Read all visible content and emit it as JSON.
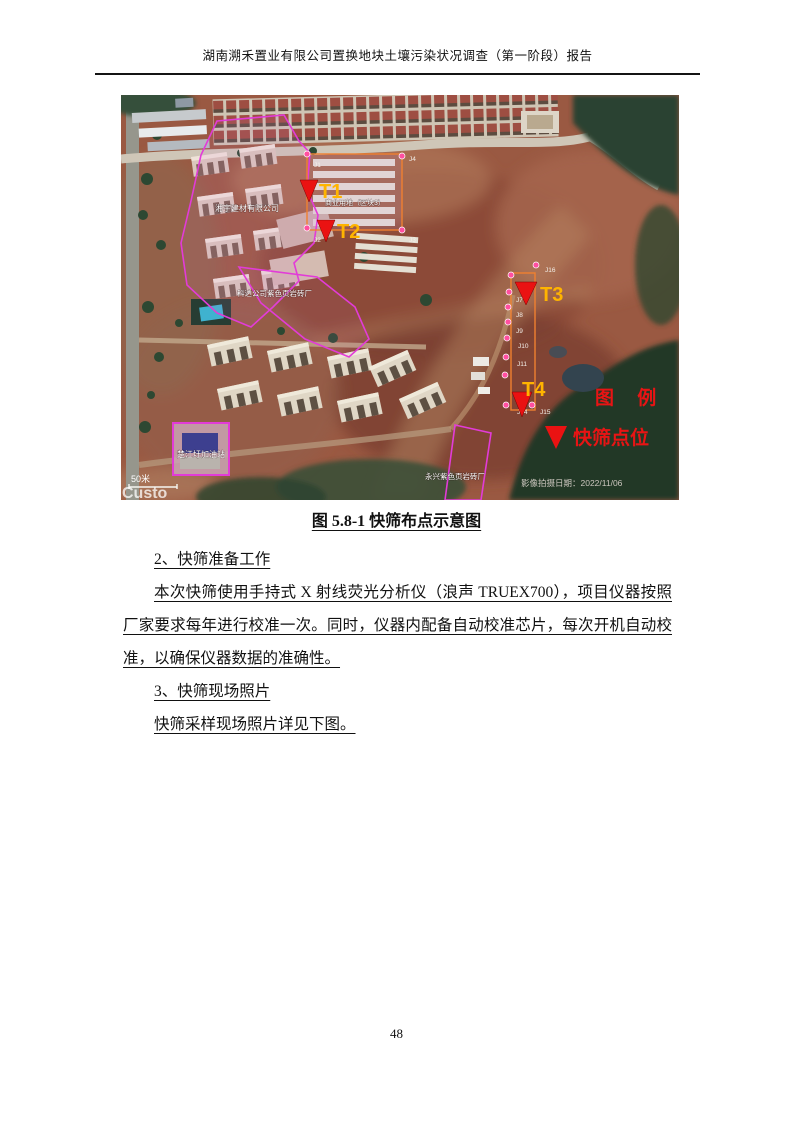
{
  "page": {
    "header_title": "湖南溯禾置业有限公司置换地块土壤污染状况调查（第一阶段）报告",
    "page_number": "48"
  },
  "figure": {
    "caption": "图 5.8-1 快筛布点示意图",
    "map": {
      "legend": {
        "title": "图 例",
        "item_label": "快筛点位"
      },
      "markers": [
        {
          "label": "T1"
        },
        {
          "label": "T2"
        },
        {
          "label": "T3"
        },
        {
          "label": "T4"
        }
      ],
      "points": {
        "j1": "J1",
        "j2": "J2",
        "j3": "J3",
        "j4": "J4",
        "j7": "J7",
        "j8": "J8",
        "j9": "J9",
        "j10": "J10",
        "j11": "J11",
        "j14": "J14",
        "j15": "J15",
        "j16": "J16"
      },
      "site_labels": {
        "factory_left": "湘宇建材有限公司",
        "land_use": "商业用地（区块3）",
        "brick_factory": "科达公司紫色页岩砖厂",
        "gas_station": "楚江圩加油站",
        "brick_factory_south": "永兴紫色页岩砖厂"
      },
      "scale_label": "50米",
      "watermark": "Custo",
      "capture_date": "影像拍摄日期：2022/11/06",
      "colors": {
        "marker_red": "#ea1212",
        "marker_label_yellow": "#ffb400",
        "legend_red": "#e81414",
        "parcel_magenta": "#e23bd8",
        "boundary_orange": "#f08030",
        "point_pink": "#ff4fa0"
      }
    }
  },
  "body": {
    "section2_heading": "2、快筛准备工作",
    "paragraph1": "本次快筛使用手持式 X 射线荧光分析仪（浪声 TRUEX700），项目仪器按照厂家要求每年进行校准一次。同时，仪器内配备自动校准芯片，每次开机自动校准，以确保仪器数据的准确性。",
    "section3_heading": "3、快筛现场照片",
    "paragraph2": "快筛采样现场照片详见下图。"
  }
}
